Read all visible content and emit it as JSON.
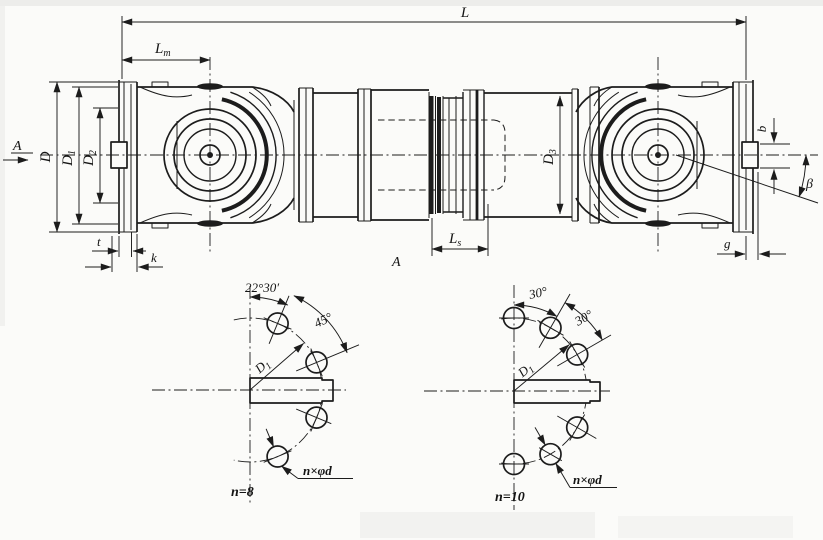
{
  "colors": {
    "ink": "#1c1c1c",
    "paper": "#fbfbf9"
  },
  "main_view": {
    "L": {
      "base": "L"
    },
    "Lm": {
      "base": "L",
      "sub": "m"
    },
    "Ls": {
      "base": "L",
      "sub": "s"
    },
    "D": {
      "base": "D"
    },
    "D1": {
      "base": "D",
      "sub": "1"
    },
    "D2": {
      "base": "D",
      "sub": "2"
    },
    "D3": {
      "base": "D",
      "sub": "3"
    },
    "t": "t",
    "k": "k",
    "g": "g",
    "b": "b",
    "beta": "β",
    "section_arrow_label": "A",
    "section_view_label": "A"
  },
  "flange_view_n8": {
    "offset_angle": "22°30′",
    "pitch_angle": "45°",
    "bolt_circle": {
      "base": "D",
      "sub": "1"
    },
    "holes_label": "n×φd",
    "hole_count": "n=8"
  },
  "flange_view_n10": {
    "offset_angle": "30°",
    "pitch_angle": "30°",
    "bolt_circle": {
      "base": "D",
      "sub": "1"
    },
    "holes_label": "n×φd",
    "hole_count": "n=10"
  }
}
